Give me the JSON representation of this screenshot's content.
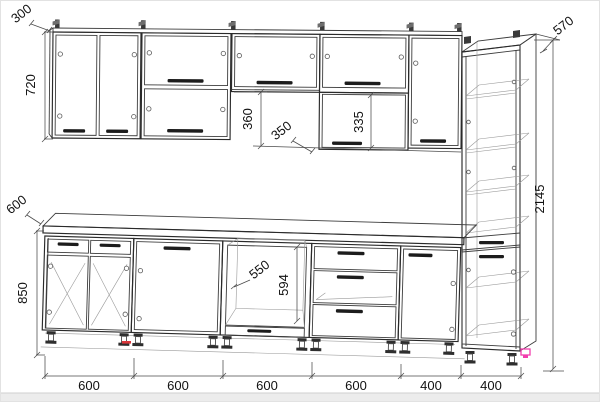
{
  "drawing": {
    "type": "kitchen-cabinet-elevation-wireframe",
    "dimensions": {
      "upper_depth": "300",
      "upper_height": "720",
      "upper_flap_opening": "360",
      "mid_box_depth": "350",
      "mid_box_door_height": "335",
      "tall_depth": "570",
      "tall_height": "2145",
      "base_depth": "600",
      "base_height": "850",
      "oven_niche_width": "550",
      "oven_niche_height": "594",
      "section_widths": [
        "600",
        "600",
        "600",
        "600",
        "400",
        "400"
      ]
    },
    "colors": {
      "background": "#ffffff",
      "line": "#3c3c3c",
      "handle": "#1c1c1c",
      "dim_text": "#111111",
      "accent_pink": "#f23dae",
      "accent_red": "#d9363a",
      "window_edge_band": "#ececec"
    }
  }
}
